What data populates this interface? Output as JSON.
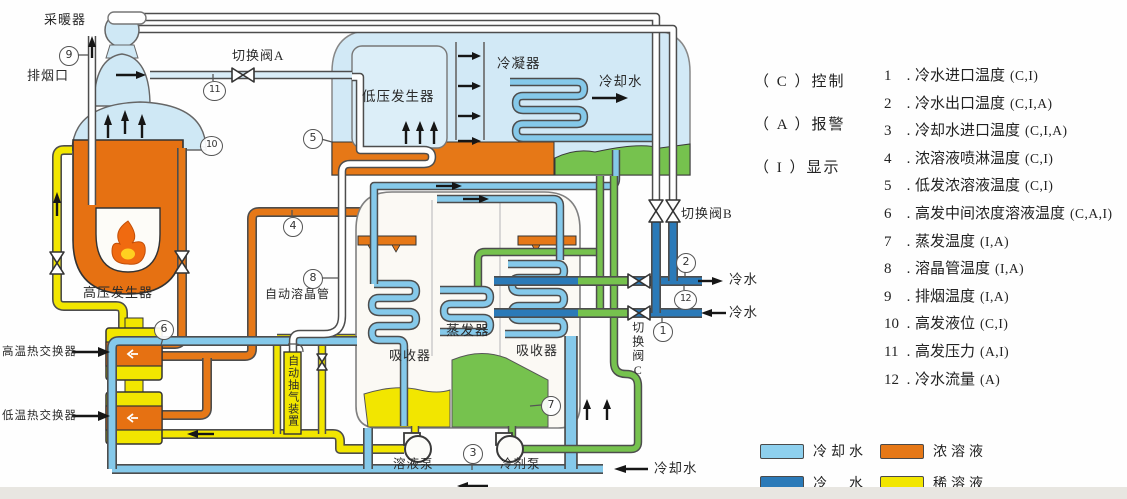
{
  "palette": {
    "cooling_water": "#85c9ea",
    "chilled_water": "#2b7ab8",
    "strong_solution": "#e67817",
    "weak_solution": "#f2e600",
    "refrigerant": "#76c24e",
    "vapor_region": "#d2e9f6"
  },
  "diagram": {
    "labels": {
      "heater": "采暖器",
      "exhaust": "排烟口",
      "valve_a": "切换阀A",
      "hp_generator": "高压发生器",
      "lp_generator": "低压发生器",
      "condenser": "冷凝器",
      "cooling_water_out": "冷却水",
      "ht_exchanger": "高温热交换器",
      "lt_exchanger": "低温热交换器",
      "crystal_tube": "自动溶晶管",
      "purge_device": "自动抽气装置",
      "evaporator": "蒸发器",
      "absorber_left": "吸收器",
      "absorber_right": "吸收器",
      "solution_pump": "溶液泵",
      "refrigerant_pump": "冷剂泵",
      "valve_b": "切换阀B",
      "valve_c": "切换阀C",
      "chilled_water_out": "冷水",
      "chilled_water_in": "冷水",
      "cooling_water_in": "冷却水"
    },
    "sensors": {
      "n1": "1",
      "n2": "2",
      "n3": "3",
      "n4": "4",
      "n5": "5",
      "n6": "6",
      "n7": "7",
      "n8": "8",
      "n9": "9",
      "n10": "10",
      "n11": "11",
      "n12": "12"
    }
  },
  "signal_key": [
    {
      "code": "（ C ）",
      "label": "控制"
    },
    {
      "code": "（ A ）",
      "label": "报警"
    },
    {
      "code": "（ I ）",
      "label": "显示"
    }
  ],
  "dot": ".",
  "monitor_points": [
    {
      "num": "1",
      "label": "冷水进口温度",
      "flags": "(C,I)"
    },
    {
      "num": "2",
      "label": "冷水出口温度",
      "flags": "(C,I,A)"
    },
    {
      "num": "3",
      "label": "冷却水进口温度",
      "flags": "(C,I,A)"
    },
    {
      "num": "4",
      "label": "浓溶液喷淋温度",
      "flags": "(C,I)"
    },
    {
      "num": "5",
      "label": "低发浓溶液温度",
      "flags": "(C,I)"
    },
    {
      "num": "6",
      "label": "高发中间浓度溶液温度",
      "flags": "(C,A,I)"
    },
    {
      "num": "7",
      "label": "蒸发温度",
      "flags": "(I,A)"
    },
    {
      "num": "8",
      "label": "溶晶管温度",
      "flags": "(I,A)"
    },
    {
      "num": "9",
      "label": "排烟温度",
      "flags": "(I,A)"
    },
    {
      "num": "10",
      "label": "高发液位",
      "flags": "(C,I)"
    },
    {
      "num": "11",
      "label": "高发压力",
      "flags": "(A,I)"
    },
    {
      "num": "12",
      "label": "冷水流量",
      "flags": "(A)"
    }
  ],
  "legend": [
    {
      "label": "冷却水",
      "color": "#8ed0ee",
      "swatch_style": "background:#8ed0ee"
    },
    {
      "label": "浓溶液",
      "color": "#e67817",
      "swatch_style": "background:#e67817"
    },
    {
      "label": "冷　水",
      "color": "#2b7ab8",
      "swatch_style": "background:#2b7ab8"
    },
    {
      "label": "稀溶液",
      "color": "#f2e600",
      "swatch_style": "background:#f2e600"
    }
  ]
}
